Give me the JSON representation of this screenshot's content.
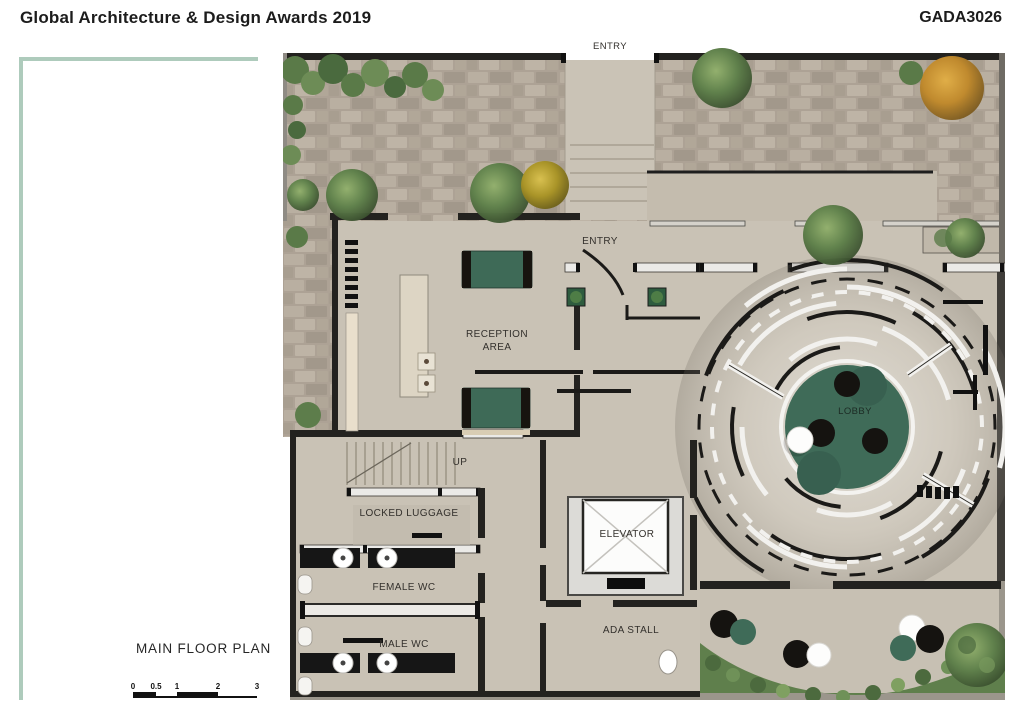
{
  "header": {
    "title": "Global Architecture & Design Awards 2019",
    "project_code": "GADA3026"
  },
  "plan": {
    "title": "MAIN FLOOR PLAN",
    "rooms": {
      "entry_top": "ENTRY",
      "entry_inner": "ENTRY",
      "reception_line1": "RECEPTION",
      "reception_line2": "AREA",
      "lobby": "LOBBY",
      "up": "UP",
      "locked_luggage": "LOCKED LUGGAGE",
      "female_wc": "FEMALE WC",
      "male_wc": "MALE WC",
      "elevator": "ELEVATOR",
      "ada_stall": "ADA STALL"
    },
    "scale_bar": {
      "ticks": [
        "0",
        "0.5",
        "1",
        "2",
        "3"
      ]
    },
    "colors": {
      "accent_green": "#aecbbc",
      "lobby_rug_green": "#3f6b58",
      "sofa_green": "#3e6a57",
      "floor_concrete": "#c9c2b5",
      "paving_stone": "#ada295",
      "wall_dark": "#23221f",
      "wall_light": "#ebeae7",
      "tree_green": "#5d7d49",
      "tree_yellow": "#a99428",
      "tree_orange": "#c08a2e"
    }
  }
}
